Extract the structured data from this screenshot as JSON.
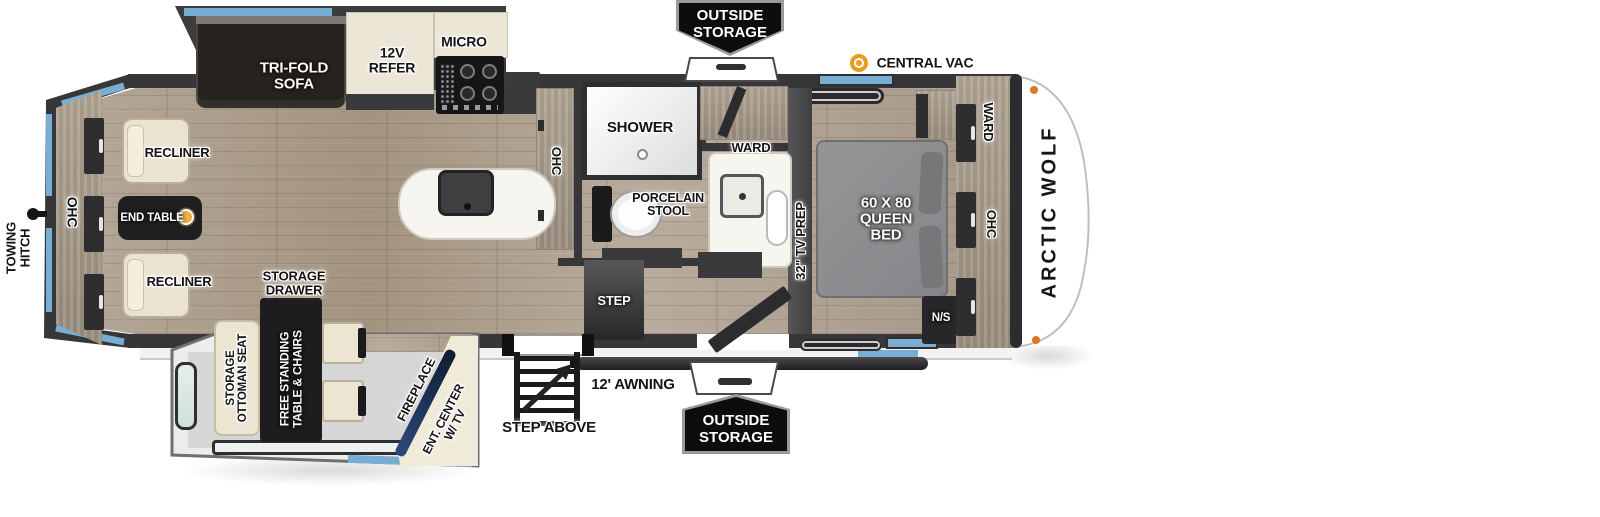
{
  "title": "Arctic Wolf fifth wheel floorplan",
  "colors": {
    "wall": "#37373a",
    "window_accent": "#78aed4",
    "wood": "#ab9e8f",
    "cream_furniture": "#ece5d2",
    "badge_bg": "#0d0d0d",
    "central_vac_orange": "#e89b22",
    "fireplace_navy": "#22365c",
    "bed_gray": "#8d8d8f"
  },
  "exterior": {
    "outside_storage_top": {
      "line1": "OUTSIDE",
      "line2": "STORAGE"
    },
    "outside_storage_bottom": {
      "line1": "OUTSIDE",
      "line2": "STORAGE"
    },
    "central_vac": "CENTRAL VAC",
    "awning": "12' AWNING",
    "step_above": "STEP ABOVE",
    "towing_hitch": {
      "line1": "TOWING",
      "line2": "HITCH"
    },
    "brand": "ARCTIC WOLF"
  },
  "living_area": {
    "ohc_rear": "OHC",
    "recliner_top": "RECLINER",
    "recliner_bottom": "RECLINER",
    "end_table": "END TABLE"
  },
  "sofa_slide": {
    "tri_fold_sofa": {
      "line1": "TRI-FOLD",
      "line2": "SOFA"
    },
    "refer": {
      "line1": "12V",
      "line2": "REFER"
    },
    "micro": "MICRO"
  },
  "kitchen": {
    "ohc": "OHC"
  },
  "bathroom": {
    "shower": "SHOWER",
    "porcelain_stool": {
      "line1": "PORCELAIN",
      "line2": "STOOL"
    },
    "ward": "WARD"
  },
  "hall": {
    "step": "STEP"
  },
  "bedroom": {
    "tv_prep": "32\" TV PREP",
    "bed": {
      "line1": "60 X 80",
      "line2": "QUEEN",
      "line3": "BED"
    },
    "night_stand": "N/S",
    "ward": "WARD",
    "ohc": "OHC"
  },
  "dinette_slide": {
    "storage_drawer": {
      "line1": "STORAGE",
      "line2": "DRAWER"
    },
    "storage_ottoman": {
      "line1": "STORAGE",
      "line2": "OTTOMAN SEAT"
    },
    "free_standing_table": {
      "line1": "FREE STANDING",
      "line2": "TABLE & CHAIRS"
    },
    "fireplace": "FIREPLACE",
    "ent_center": {
      "line1": "ENT. CENTER",
      "line2": "W/ TV"
    }
  }
}
